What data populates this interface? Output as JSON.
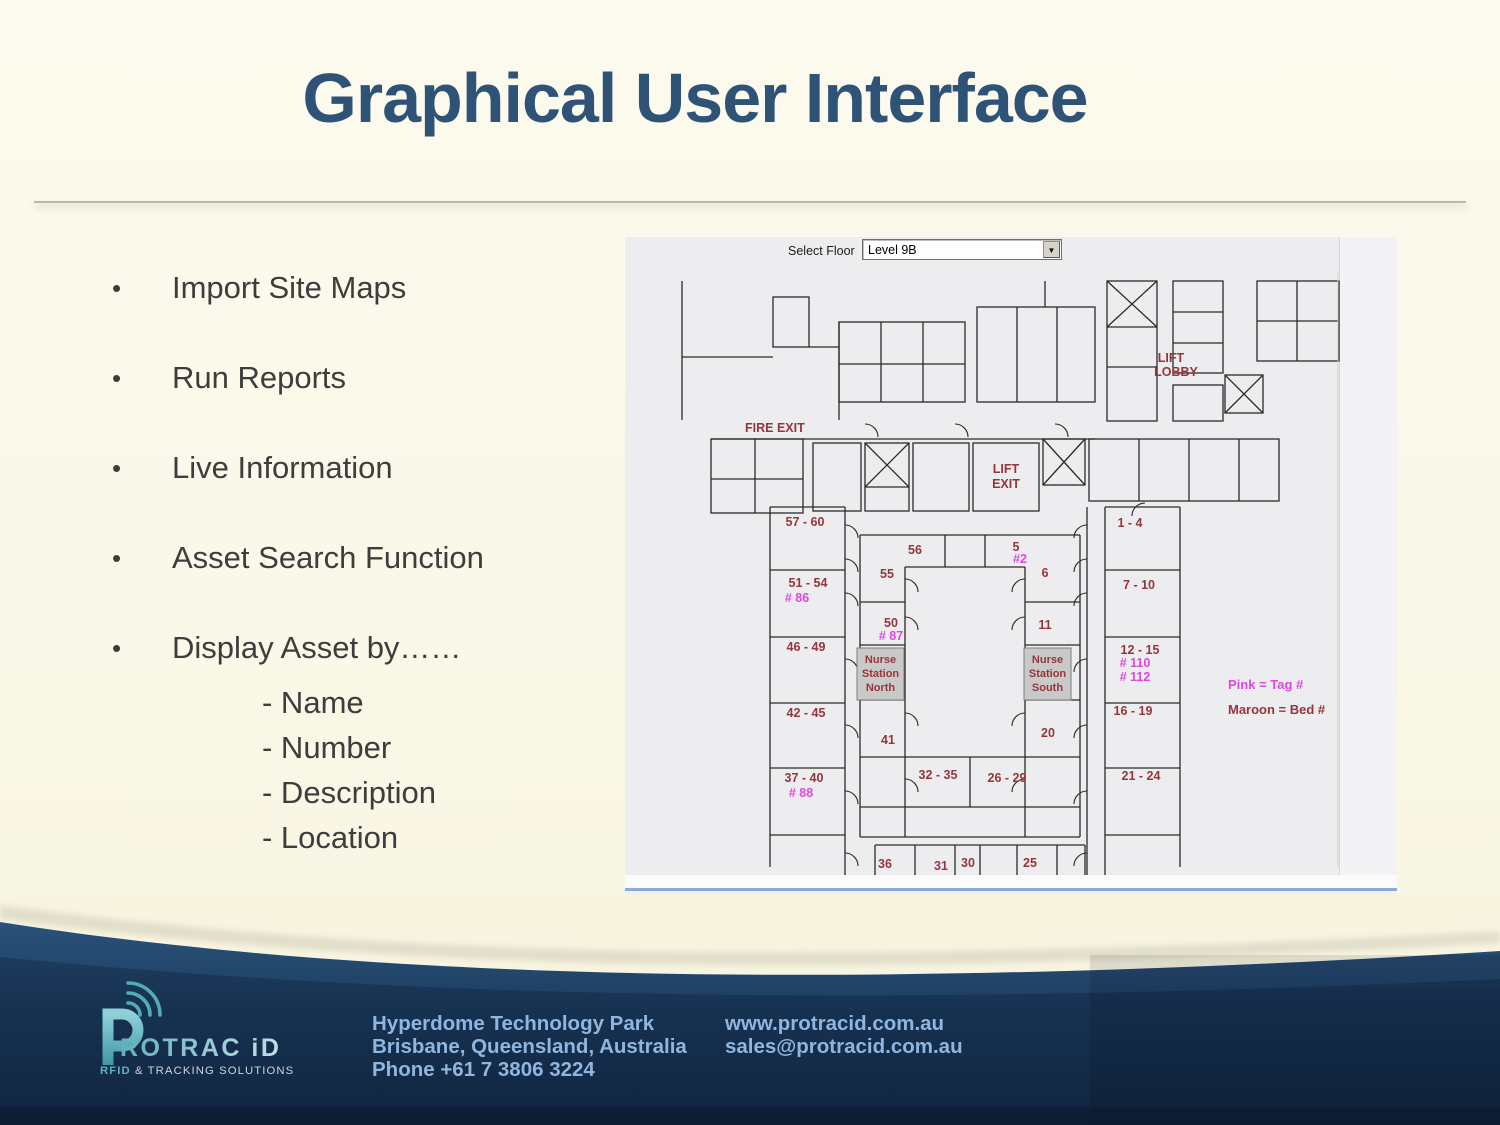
{
  "slide": {
    "title": "Graphical User Interface",
    "bullet_char": "•",
    "bullets": [
      "Import Site Maps",
      "Run Reports",
      "Live Information",
      "Asset Search Function",
      "Display Asset by……"
    ],
    "sub_bullets": [
      "- Name",
      "- Number",
      "- Description",
      "- Location"
    ]
  },
  "app": {
    "select_floor_label": "Select Floor",
    "floor_value": "Level 9B",
    "icons": {
      "dropdown_arrow": "▼"
    },
    "colors": {
      "maroon": "#96353B",
      "pink": "#DF47DF",
      "wall": "#2b2b2b",
      "station_fill": "#c9c9c9",
      "station_border": "#7d7d7d"
    },
    "labels": [
      {
        "t": "FIRE EXIT",
        "x": 120,
        "y": 165,
        "c": "maroon",
        "a": "start"
      },
      {
        "t": "LIFT",
        "x": 546,
        "y": 95,
        "c": "maroon"
      },
      {
        "t": "LOBBY",
        "x": 551,
        "y": 109,
        "c": "maroon"
      },
      {
        "t": "LIFT",
        "x": 381,
        "y": 206,
        "c": "maroon"
      },
      {
        "t": "EXIT",
        "x": 381,
        "y": 221,
        "c": "maroon"
      },
      {
        "t": "57 - 60",
        "x": 180,
        "y": 259,
        "c": "maroon"
      },
      {
        "t": "51 - 54",
        "x": 183,
        "y": 320,
        "c": "maroon"
      },
      {
        "t": "# 86",
        "x": 172,
        "y": 335,
        "c": "pink"
      },
      {
        "t": "46 - 49",
        "x": 181,
        "y": 384,
        "c": "maroon"
      },
      {
        "t": "42 - 45",
        "x": 181,
        "y": 450,
        "c": "maroon"
      },
      {
        "t": "37 - 40",
        "x": 179,
        "y": 515,
        "c": "maroon"
      },
      {
        "t": "# 88",
        "x": 176,
        "y": 530,
        "c": "pink"
      },
      {
        "t": "56",
        "x": 290,
        "y": 287,
        "c": "maroon"
      },
      {
        "t": "5",
        "x": 391,
        "y": 284,
        "c": "maroon"
      },
      {
        "t": "#2",
        "x": 395,
        "y": 296,
        "c": "pink"
      },
      {
        "t": "55",
        "x": 262,
        "y": 311,
        "c": "maroon"
      },
      {
        "t": "6",
        "x": 420,
        "y": 310,
        "c": "maroon"
      },
      {
        "t": "50",
        "x": 266,
        "y": 360,
        "c": "maroon"
      },
      {
        "t": "# 87",
        "x": 266,
        "y": 373,
        "c": "pink"
      },
      {
        "t": "11",
        "x": 420,
        "y": 362,
        "c": "maroon"
      },
      {
        "t": "1 - 4",
        "x": 505,
        "y": 260,
        "c": "maroon"
      },
      {
        "t": "7 - 10",
        "x": 514,
        "y": 322,
        "c": "maroon"
      },
      {
        "t": "12 - 15",
        "x": 515,
        "y": 387,
        "c": "maroon"
      },
      {
        "t": "# 110",
        "x": 510,
        "y": 400,
        "c": "pink"
      },
      {
        "t": "# 112",
        "x": 510,
        "y": 414,
        "c": "pink"
      },
      {
        "t": "16 - 19",
        "x": 508,
        "y": 448,
        "c": "maroon"
      },
      {
        "t": "21 - 24",
        "x": 516,
        "y": 513,
        "c": "maroon"
      },
      {
        "t": "41",
        "x": 263,
        "y": 477,
        "c": "maroon"
      },
      {
        "t": "20",
        "x": 423,
        "y": 470,
        "c": "maroon"
      },
      {
        "t": "32 - 35",
        "x": 313,
        "y": 512,
        "c": "maroon"
      },
      {
        "t": "26 - 29",
        "x": 382,
        "y": 515,
        "c": "maroon"
      },
      {
        "t": "36",
        "x": 260,
        "y": 601,
        "c": "maroon"
      },
      {
        "t": "31",
        "x": 316,
        "y": 603,
        "c": "maroon"
      },
      {
        "t": "30",
        "x": 343,
        "y": 600,
        "c": "maroon"
      },
      {
        "t": "25",
        "x": 405,
        "y": 600,
        "c": "maroon"
      },
      {
        "t": "Pink = Tag #",
        "x": 603,
        "y": 422,
        "c": "pink",
        "a": "start",
        "s": 13
      },
      {
        "t": "Maroon = Bed #",
        "x": 603,
        "y": 447,
        "c": "maroon",
        "a": "start",
        "s": 13
      }
    ],
    "stations": [
      {
        "lines": [
          "Nurse",
          "Station",
          "North"
        ],
        "x": 232,
        "y": 381,
        "w": 47,
        "h": 52
      },
      {
        "lines": [
          "Nurse",
          "Station",
          "South"
        ],
        "x": 399,
        "y": 381,
        "w": 47,
        "h": 52
      }
    ]
  },
  "footer": {
    "logo": {
      "letter": "P",
      "brand": "ROTRAC iD",
      "tagline_rfid": "RFID",
      "tagline_rest": " & TRACKING SOLUTIONS"
    },
    "address_lines": [
      "Hyperdome Technology Park",
      "Brisbane, Queensland, Australia",
      "Phone  +61 7 3806 3224"
    ],
    "web_lines": [
      "www.protracid.com.au",
      "sales@protracid.com.au"
    ]
  }
}
